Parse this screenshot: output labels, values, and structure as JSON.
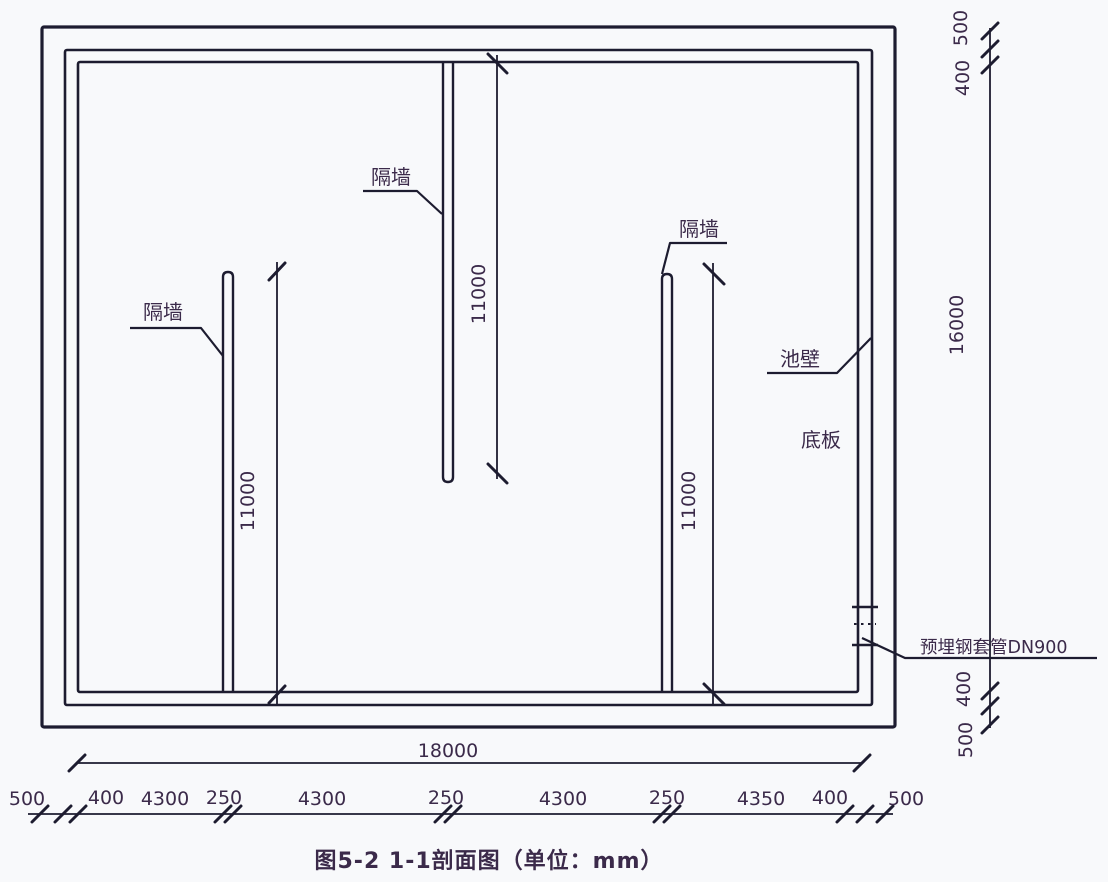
{
  "figure": {
    "caption": "图5-2  1-1剖面图（单位：mm）"
  },
  "labels": {
    "partition_left": "隔墙",
    "partition_middle": "隔墙",
    "partition_right": "隔墙",
    "pool_wall": "池壁",
    "base_slab": "底板",
    "embedded_sleeve": "预埋钢套管DN900"
  },
  "dimensions": {
    "partition_left_height": "11000",
    "partition_middle_height": "11000",
    "partition_right_height": "11000",
    "inner_width": "18000",
    "inner_height": "16000",
    "right_top": {
      "slab_extend": "500",
      "wall_thickness": "400"
    },
    "right_bottom": {
      "wall_thickness": "400",
      "slab_extend": "500"
    },
    "bottom_chain": [
      "500",
      "400",
      "4300",
      "250",
      "4300",
      "250",
      "4300",
      "250",
      "4350",
      "400",
      "500"
    ]
  },
  "colors": {
    "line": "#1d1c30",
    "text": "#3b2a4a",
    "background": "#f8f9fb"
  }
}
